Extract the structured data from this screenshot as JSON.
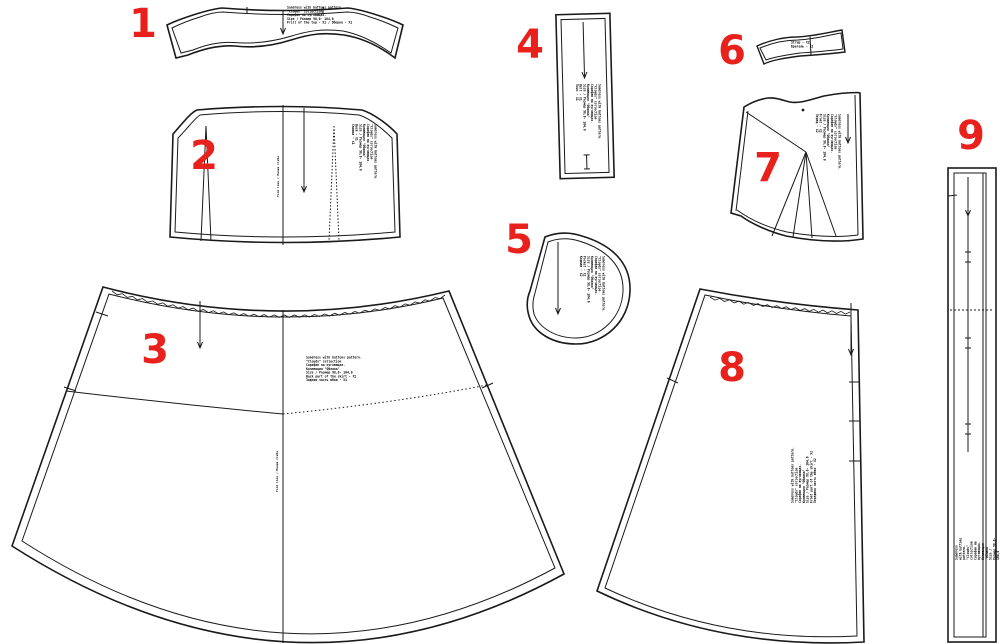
{
  "colors": {
    "background": "#ffffff",
    "line": "#1a1a1a",
    "number_red": "#e8211d"
  },
  "legend": {
    "fold_line_label": "Fold line / Линия сгиба"
  },
  "pieces": [
    {
      "number": "1",
      "name": "top frill band",
      "info": "Sundress with buttons pattern.\n\"Clouds\" collection\nСарафан на пуговицах.\nSize / Размер  98,0- 104,0\nFrill of the top - Х1 / Оборка - Х1"
    },
    {
      "number": "2",
      "name": "back bodice",
      "info": "Sundress with buttons pattern.\n\"Clouds\" collection\nСарафан на пуговицах.\nКоллекция \"Облака\"\nSize / Размер  98,0- 104,0\nBack - Х1\nСпинка - Х1"
    },
    {
      "number": "3",
      "name": "back skirt",
      "info": "Sundress with buttons pattern.\n\"Clouds\" collection\nСарафан на пуговицах.\nКоллекция \"Облака\"\nSize / Размер  98,0- 104,0\nBack part of the skirt - Х1\nЗадняя часть юбки - Х1"
    },
    {
      "number": "4",
      "name": "belt strip",
      "info": "Sundress with buttons pattern.\n\"Clouds\" collection\nСарафан на пуговицах.\nКоллекция \"Облака\"\nSize / Размер  98,0- 104,0\nBelt - Х1\nПояс - Х1"
    },
    {
      "number": "5",
      "name": "pocket",
      "info": "Sundress with buttons pattern.\n\"Clouds\" collection\nСарафан на пуговицах.\nКоллекция \"Облака\"\nSize / Размер  98,0- 104,0\nPocket - Х2\nКарман - Х2"
    },
    {
      "number": "6",
      "name": "strap",
      "info": "Strap - Х2\nБретель - Х2"
    },
    {
      "number": "7",
      "name": "front bodice",
      "info": "Sundress with buttons pattern.\n\"Clouds\" collection\nСарафан на пуговицах.\nКоллекция \"Облака\"\nSize / Размер  98,0- 104,0\nFront - Х2\nПеред - Х2"
    },
    {
      "number": "8",
      "name": "front skirt",
      "info": "Sundress with buttons pattern.\n\"Clouds\" collection\nСарафан на пуговицах.\nКоллекция \"Облака\"\nSize / Размер  98,0- 104,0\nFront part of the skirt - Х2\nПередняя часть юбки - Х2"
    },
    {
      "number": "9",
      "name": "button placket",
      "info": "Sundress with buttons pattern.\n\"Clouds\" collection\nСарафан на пуговицах.\nКоллекция \"Облака\"\nSize / Размер  98,0- 104,0\nPlacket - Х1\nПланка - Х1"
    }
  ]
}
